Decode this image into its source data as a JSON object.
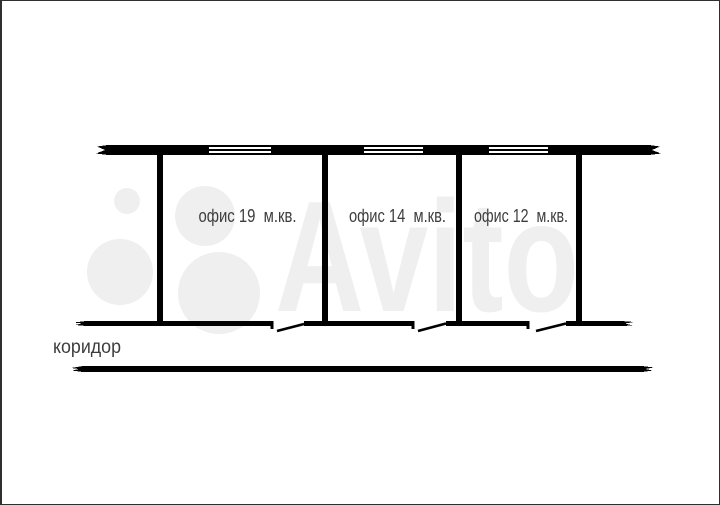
{
  "plan": {
    "rooms": [
      {
        "name": "office-19",
        "label": "офис 19  м.кв."
      },
      {
        "name": "office-14",
        "label": "офис 14  м.кв."
      },
      {
        "name": "office-12",
        "label": "офис 12  м.кв."
      }
    ],
    "corridor": {
      "label": "коридор"
    },
    "watermark": {
      "text": "Avito"
    },
    "colors": {
      "wall": "#000000",
      "label_text": "#3d3d3d",
      "watermark": "#efefef",
      "background": "#ffffff",
      "border": "#2f2f2f"
    }
  }
}
